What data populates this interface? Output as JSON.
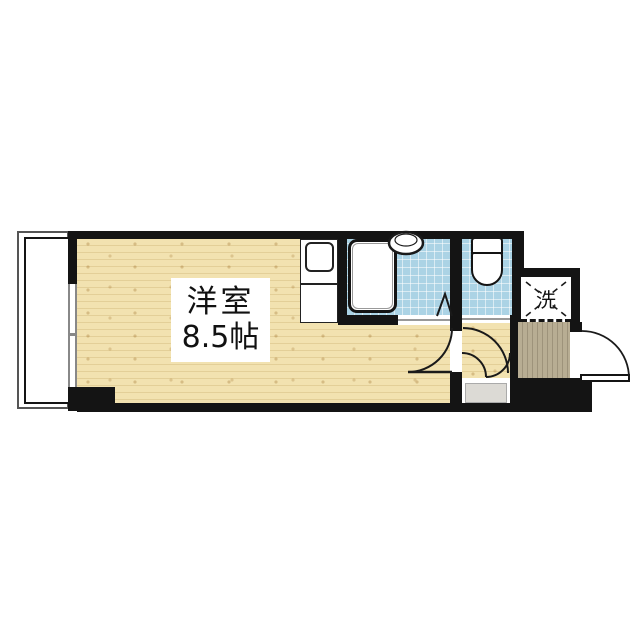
{
  "floorplan": {
    "labels": {
      "main_room_line1": "洋室",
      "main_room_line2": "8.5帖",
      "laundry": "洗"
    },
    "colors": {
      "wall": "#141414",
      "wood_floor": "#f2e2b0",
      "tile_blue": "#abd3e5",
      "entrance_tile": "#b8ad93",
      "step_gray": "#dcdad5",
      "outline_gray": "#555555",
      "paper": "#ffffff"
    }
  }
}
